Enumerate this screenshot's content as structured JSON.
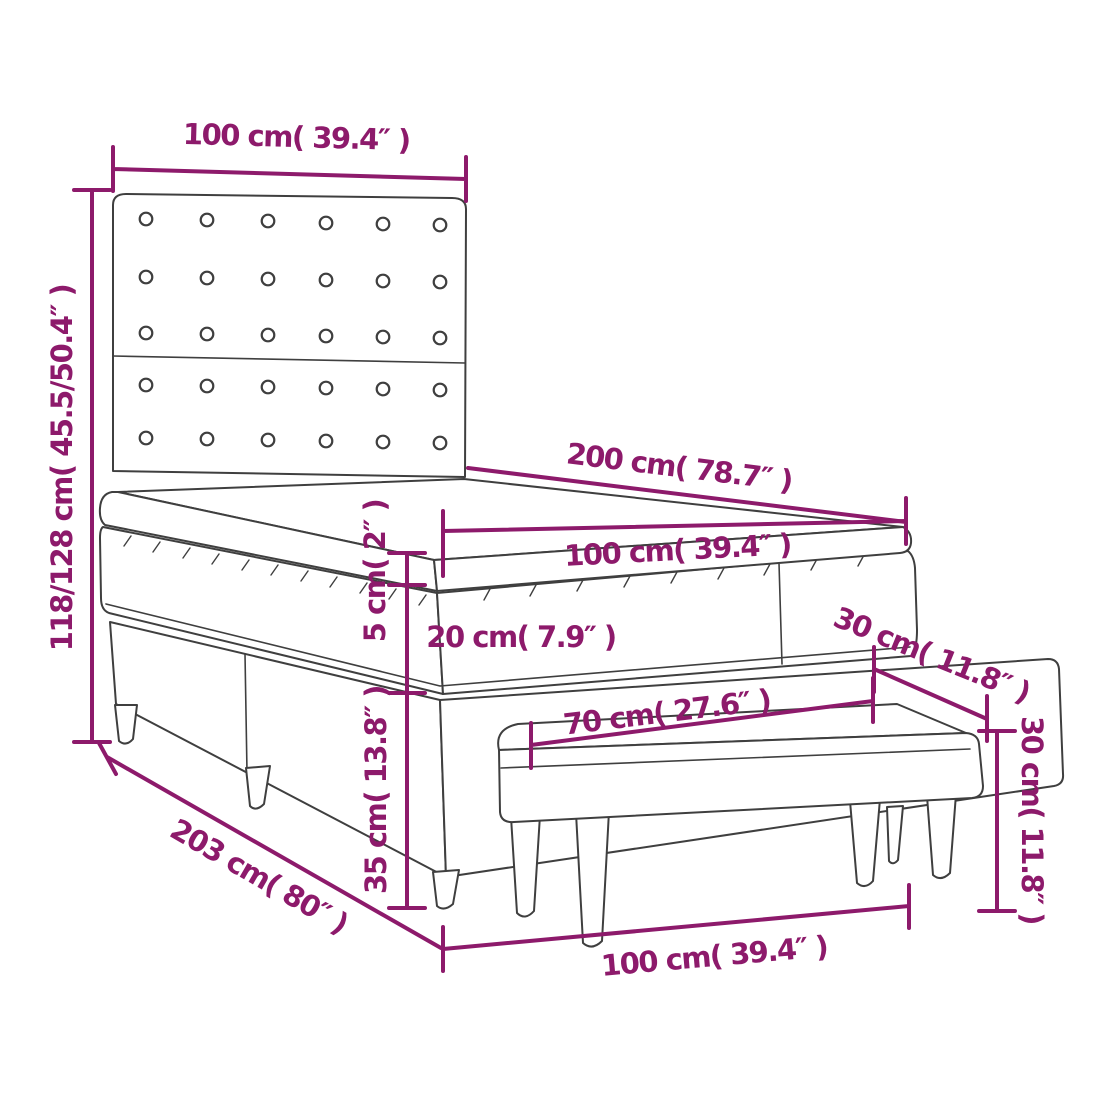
{
  "diagram": {
    "type": "furniture-dimension-diagram",
    "dimensions": {
      "headboard_width": "100 cm( 39.4″ )",
      "total_height": "118/128 cm( 45.5/50.4″ )",
      "mattress_length": "200 cm( 78.7″ )",
      "mattress_width": "100 cm( 39.4″ )",
      "topper_thickness": "5 cm( 2″ )",
      "mattress_thickness": "20 cm( 7.9″ )",
      "bench_depth": "30 cm( 11.8″ )",
      "bench_length": "70 cm( 27.6″ )",
      "base_height": "35 cm( 13.8″ )",
      "bench_height": "30 cm( 11.8″ )",
      "base_length": "203 cm( 80″ )",
      "base_width": "100 cm( 39.4″ )"
    },
    "colors": {
      "dimension": "#8d1a6b",
      "outline": "#3f3f3f",
      "background": "#ffffff"
    }
  }
}
